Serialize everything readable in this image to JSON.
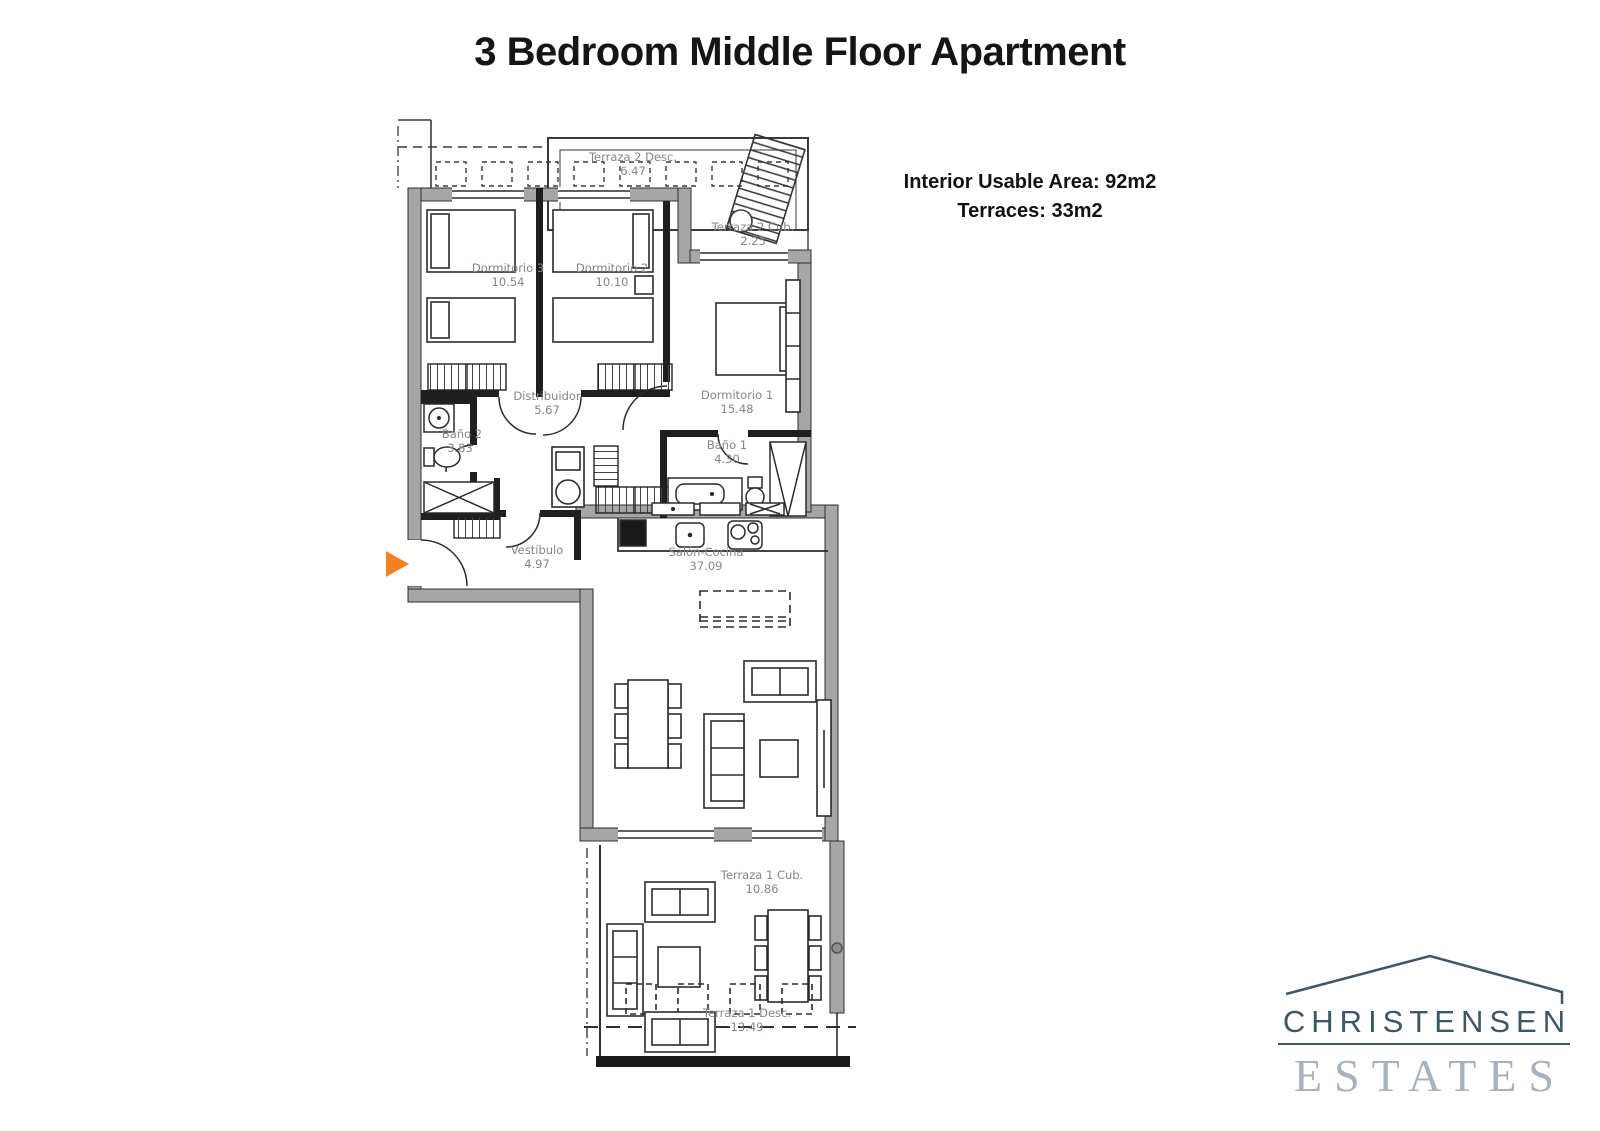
{
  "title": "3 Bedroom Middle Floor Apartment",
  "summary": {
    "interior": "Interior Usable Area: 92m2",
    "terraces": "Terraces: 33m2"
  },
  "rooms": [
    {
      "name": "Terraza 2 Desc.",
      "area": "6.47"
    },
    {
      "name": "Terraza 2 Cub.",
      "area": "2.25"
    },
    {
      "name": "Dormitorio 3",
      "area": "10.54"
    },
    {
      "name": "Dormitorio 2",
      "area": "10.10"
    },
    {
      "name": "Dormitorio 1",
      "area": "15.48"
    },
    {
      "name": "Distribuidor",
      "area": "5.67"
    },
    {
      "name": "Baño 2",
      "area": "3.83"
    },
    {
      "name": "Baño 1",
      "area": "4.30"
    },
    {
      "name": "Vestíbulo",
      "area": "4.97"
    },
    {
      "name": "Salón-Cocina",
      "area": "37.09"
    },
    {
      "name": "Terraza 1 Cub.",
      "area": "10.86"
    },
    {
      "name": "Terraza 1 Desc.",
      "area": "13.49"
    }
  ],
  "logo": {
    "line1": "CHRISTENSEN",
    "line2": "ESTATES"
  },
  "colors": {
    "wall_gray": "#a6a6a6",
    "line_dark": "#2e2e2e",
    "label_gray": "#80868f",
    "entrance_orange": "#f58220",
    "logo_dark": "#3d5766",
    "logo_light": "#a5b2c2"
  }
}
